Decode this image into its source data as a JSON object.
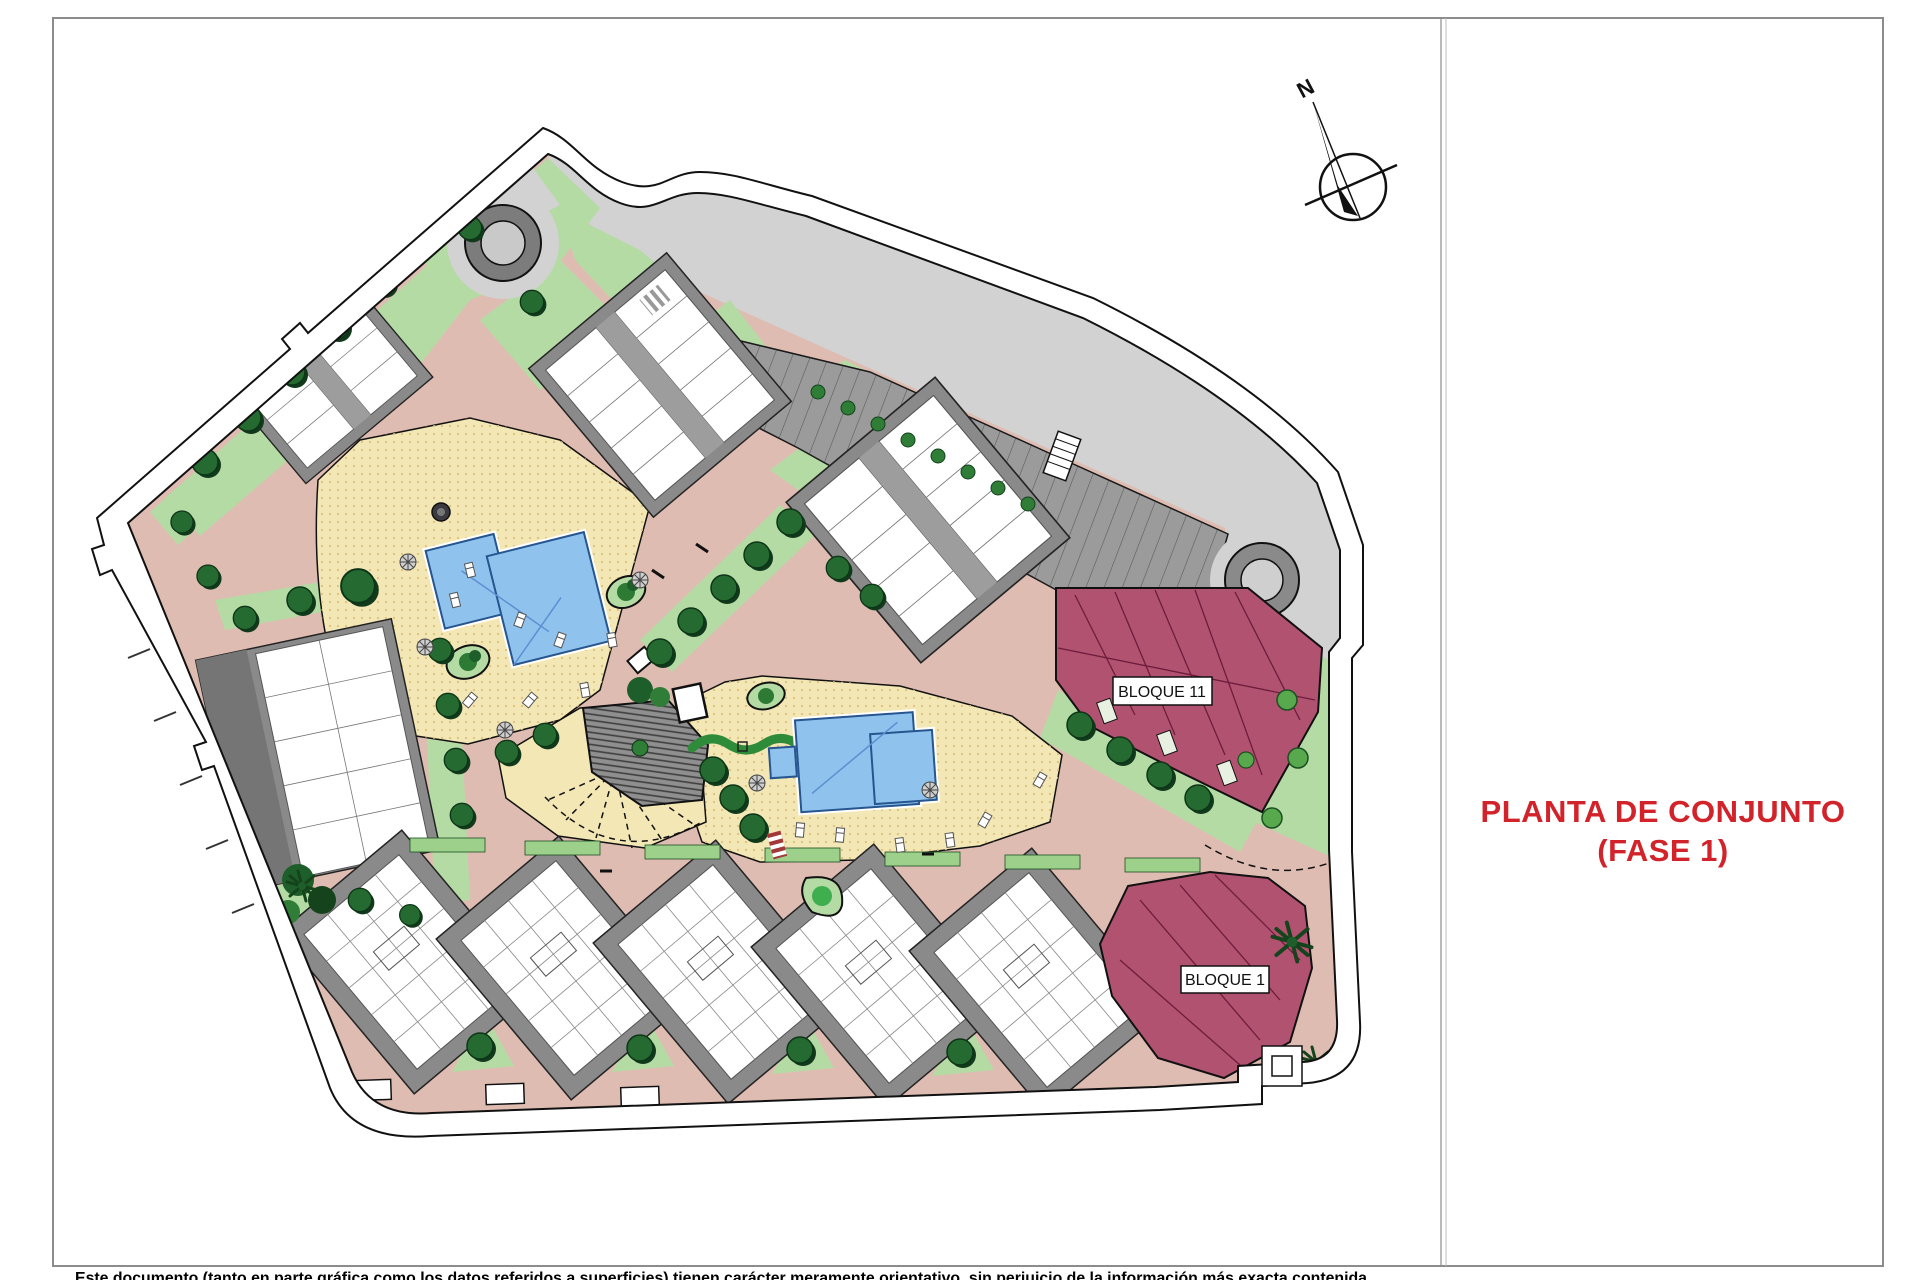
{
  "document": {
    "title_line1": "PLANTA DE CONJUNTO",
    "title_line2": "(FASE 1)",
    "disclaimer": "Este documento (tanto en parte gráfica como los datos referidos a superficies) tienen carácter meramente orientativo, sin perjuicio de la información más exacta contenida",
    "compass_label": "N"
  },
  "plan": {
    "block_labels": {
      "bloque11": "BLOQUE 11",
      "bloque1": "BLOQUE 1"
    }
  },
  "colors": {
    "title_red": "#d2232a",
    "block_maroon": "#b15270",
    "path_salmon": "#dfbcb1",
    "deck_yellow": "#f3e7b5",
    "pool_blue": "#8fc3ee",
    "green_light": "#b5dba5",
    "green_dark": "#1e5e2a",
    "road_gray": "#d2d2d2",
    "parking_gray": "#9b9b9b",
    "plinth_gray": "#8a8a8a",
    "building_white": "#ffffff"
  }
}
